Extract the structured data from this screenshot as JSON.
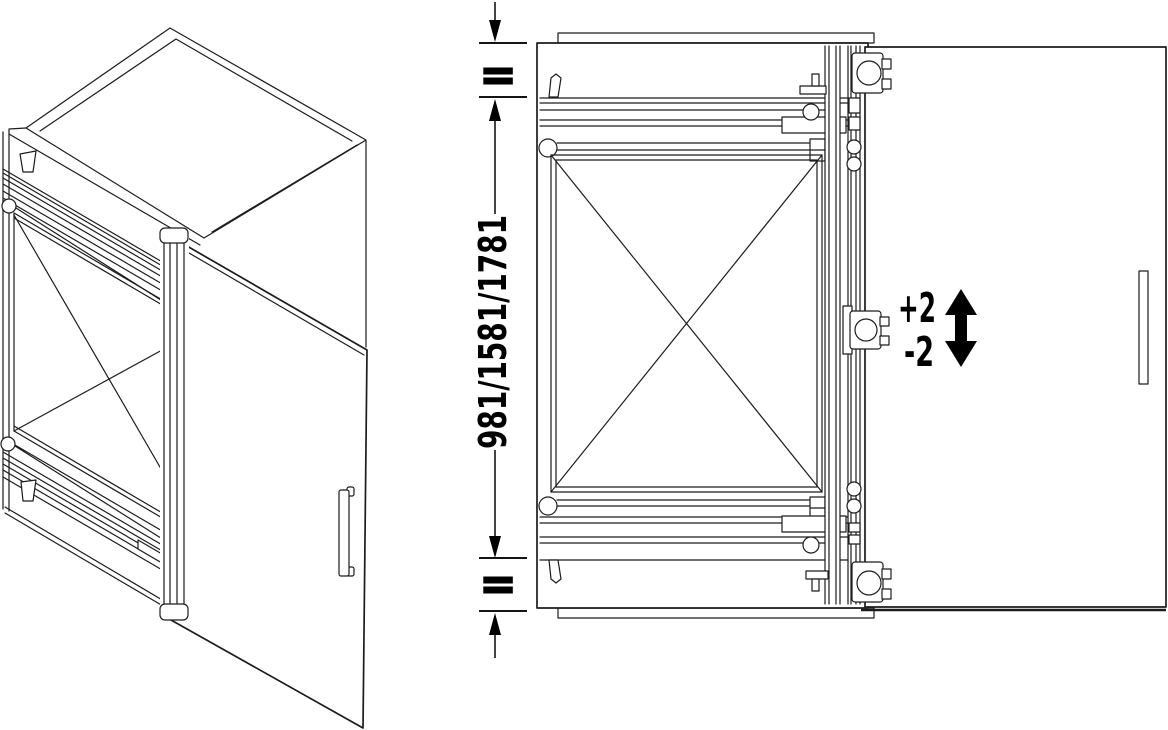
{
  "diagram": {
    "annotations": {
      "height_label": "981/1581/1781",
      "equal_top": "=",
      "equal_bottom": "=",
      "adjust_up": "+2",
      "adjust_down": "-2"
    },
    "icons": {
      "dimension_arrows": "dimension-arrow-icon",
      "adjustment_arrow": "vertical-double-arrow-icon"
    },
    "colors": {
      "line": "#1c1c1c",
      "annotation": "#000000",
      "background": "#ffffff"
    }
  }
}
